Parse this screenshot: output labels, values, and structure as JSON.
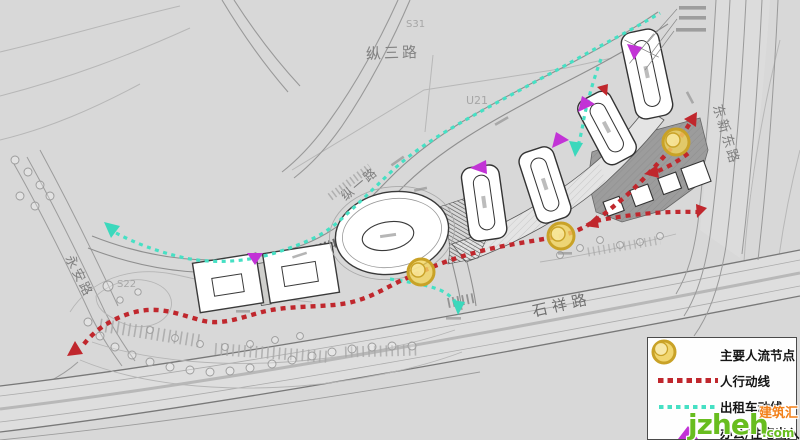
{
  "map": {
    "roads": {
      "top": "纵三路",
      "inner": "纵一路",
      "bottom": "石祥路",
      "east": "东新东路",
      "west": "永安路"
    },
    "parcels": {
      "s31": "S31",
      "u21": "U21",
      "s22": "S22"
    }
  },
  "legend": {
    "items": [
      {
        "id": "node",
        "label": "主要人流节点"
      },
      {
        "id": "pedestrian",
        "label": "人行动线"
      },
      {
        "id": "taxi",
        "label": "出租车动线"
      },
      {
        "id": "entrance",
        "label": "办公/住宅出入口"
      }
    ]
  },
  "watermark": {
    "site": "jzheh",
    "tld": ".com",
    "badge": "建筑汇"
  },
  "colors": {
    "pedestrian_red": "#c0272d",
    "taxi_cyan": "#46e0c4",
    "entrance_magenta": "#c233d6",
    "node_gold": "#c9a227",
    "background": "#d8d8d8"
  }
}
